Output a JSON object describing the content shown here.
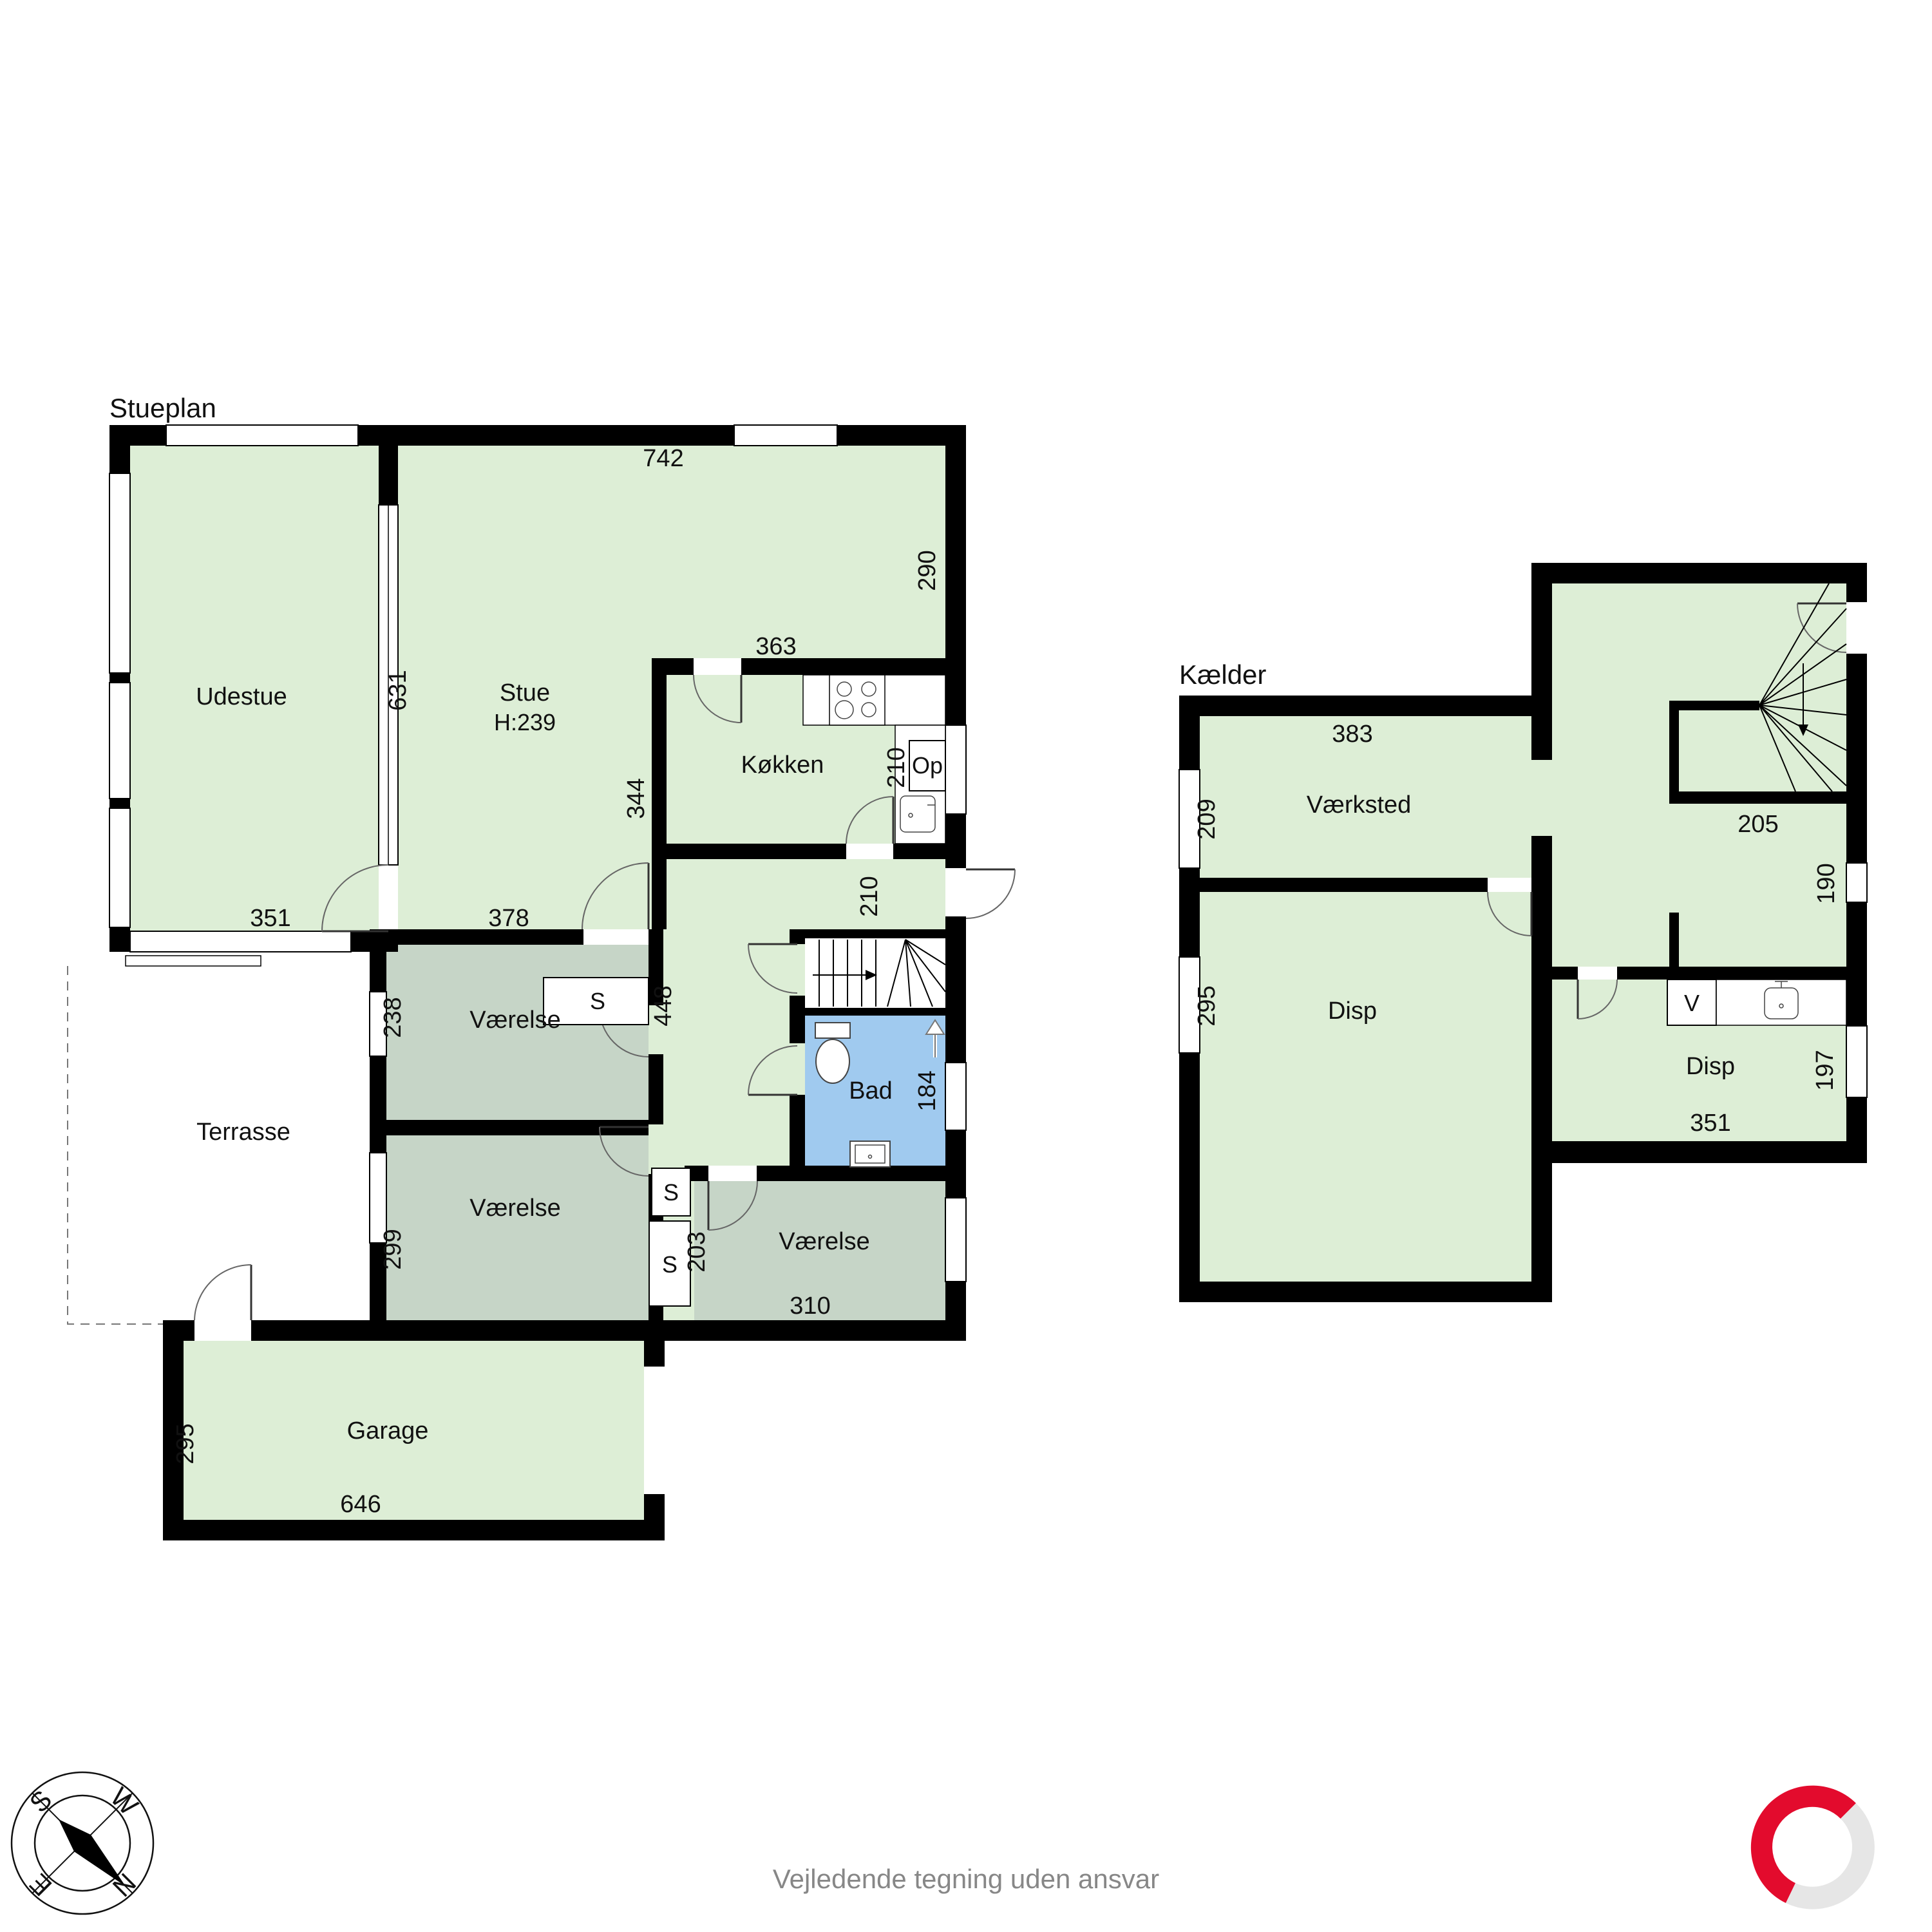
{
  "footer": {
    "disclaimer": "Vejledende tegning uden ansvar"
  },
  "colors": {
    "room_green": "#ddeed6",
    "room_gray": "#c6d5c7",
    "bath_blue": "#a0caef",
    "wall_black": "#000000",
    "logo_red": "#e30b2d",
    "logo_gray": "#e6e6e6",
    "footer_gray": "#878787"
  },
  "compass": {
    "n": "N",
    "s": "S",
    "e": "E",
    "w": "W"
  },
  "ground": {
    "title": "Stueplan",
    "rooms": {
      "udestue": "Udestue",
      "stue": "Stue",
      "stue_h": "H:239",
      "kokken": "Køkken",
      "op": "Op",
      "v1": "Værelse",
      "v2": "Værelse",
      "v3": "Værelse",
      "bad": "Bad",
      "terrasse": "Terrasse",
      "garage": "Garage",
      "s1": "S",
      "s2": "S",
      "s3": "S"
    },
    "dims": {
      "d742": "742",
      "d290": "290",
      "d363": "363",
      "d210k": "210",
      "d631": "631",
      "d344": "344",
      "d210h": "210",
      "d351": "351",
      "d378": "378",
      "d448": "448",
      "d238": "238",
      "d299": "299",
      "d203": "203",
      "d310": "310",
      "d184": "184",
      "d295": "295",
      "d646": "646"
    }
  },
  "basement": {
    "title": "Kælder",
    "rooms": {
      "vaerksted": "Værksted",
      "disp1": "Disp",
      "disp2": "Disp",
      "v": "V"
    },
    "dims": {
      "d383": "383",
      "d209": "209",
      "d205": "205",
      "d190": "190",
      "d295": "295",
      "d197": "197",
      "d351": "351"
    }
  }
}
